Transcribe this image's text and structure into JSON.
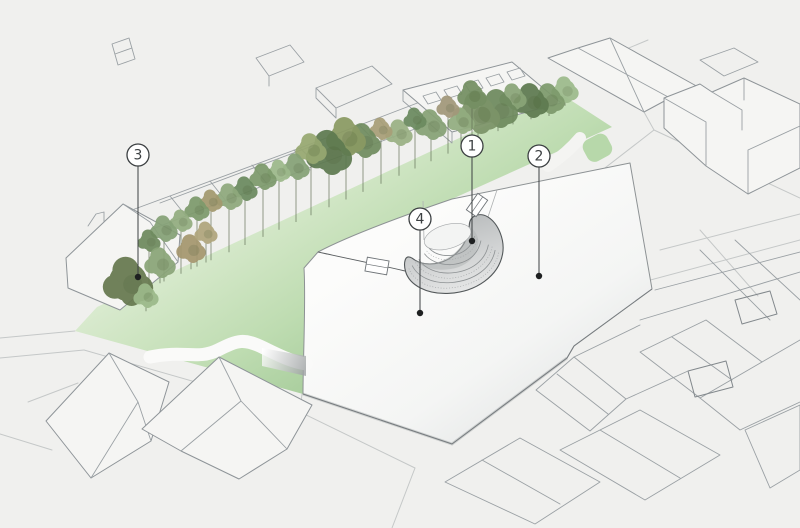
{
  "figure": {
    "callout_style": {
      "radius": 11,
      "ink": "#3c4042",
      "dot_color": "#1e2021",
      "fill": "#ffffff"
    },
    "callouts": [
      {
        "label": "1",
        "cx": 472,
        "cy": 146,
        "dot_y": 241
      },
      {
        "label": "2",
        "cx": 539,
        "cy": 156,
        "dot_y": 276
      },
      {
        "label": "3",
        "cx": 138,
        "cy": 155,
        "dot_y": 277
      },
      {
        "label": "4",
        "cx": 420,
        "cy": 219,
        "dot_y": 313
      }
    ],
    "palette": {
      "background": "#f0f0ee",
      "lawn_light": "#e6f1de",
      "lawn_mid": "#cfe5c3",
      "lawn_dark": "#abcf9f",
      "plaza_fill": "#fcfcfb",
      "plaza_shade": "#e2e4e4",
      "amphitheater_light": "#e6e7e7",
      "amphitheater_dark": "#b9bcbd",
      "outline_ink": "#53585a",
      "building_stroke": "#9aa0a4",
      "trunk": "#5d6b52"
    },
    "trees": [
      {
        "x": 565,
        "y": 90,
        "r": 13,
        "c": "#9dbb8c"
      },
      {
        "x": 549,
        "y": 99,
        "r": 15,
        "c": "#7d9a6c"
      },
      {
        "x": 531,
        "y": 101,
        "r": 17,
        "c": "#5e7a50"
      },
      {
        "x": 513,
        "y": 97,
        "r": 13,
        "c": "#8aa578"
      },
      {
        "x": 498,
        "y": 109,
        "r": 19,
        "c": "#6e8a5e"
      },
      {
        "x": 478,
        "y": 113,
        "r": 21,
        "c": "#7c9468"
      },
      {
        "x": 461,
        "y": 121,
        "r": 13,
        "c": "#93ad80"
      },
      {
        "x": 448,
        "y": 107,
        "r": 11,
        "c": "#a2987a"
      },
      {
        "x": 431,
        "y": 125,
        "r": 15,
        "c": "#87a276"
      },
      {
        "x": 415,
        "y": 119,
        "r": 11,
        "c": "#6b8a5f"
      },
      {
        "x": 399,
        "y": 133,
        "r": 13,
        "c": "#9ab184"
      },
      {
        "x": 381,
        "y": 129,
        "r": 11,
        "c": "#a89f78"
      },
      {
        "x": 363,
        "y": 141,
        "r": 17,
        "c": "#708c60"
      },
      {
        "x": 346,
        "y": 137,
        "r": 19,
        "c": "#8a9a63"
      },
      {
        "x": 329,
        "y": 153,
        "r": 22,
        "c": "#5e7a50"
      },
      {
        "x": 311,
        "y": 149,
        "r": 15,
        "c": "#97a871"
      },
      {
        "x": 296,
        "y": 167,
        "r": 13,
        "c": "#86a277"
      },
      {
        "x": 279,
        "y": 171,
        "r": 11,
        "c": "#9db98b"
      },
      {
        "x": 263,
        "y": 177,
        "r": 13,
        "c": "#7d9a6c"
      },
      {
        "x": 245,
        "y": 189,
        "r": 12,
        "c": "#6b8a5f"
      },
      {
        "x": 229,
        "y": 197,
        "r": 13,
        "c": "#8fa97d"
      },
      {
        "x": 211,
        "y": 201,
        "r": 11,
        "c": "#a3996f"
      },
      {
        "x": 197,
        "y": 209,
        "r": 12,
        "c": "#7d9a6c"
      },
      {
        "x": 181,
        "y": 221,
        "r": 11,
        "c": "#93ad80"
      },
      {
        "x": 164,
        "y": 229,
        "r": 13,
        "c": "#86a277"
      },
      {
        "x": 149,
        "y": 241,
        "r": 11,
        "c": "#6e8a5e"
      },
      {
        "x": 128,
        "y": 282,
        "r": 24,
        "c": "#66794f"
      },
      {
        "x": 160,
        "y": 263,
        "r": 15,
        "c": "#8aa578"
      },
      {
        "x": 146,
        "y": 296,
        "r": 12,
        "c": "#9cb98a"
      },
      {
        "x": 191,
        "y": 249,
        "r": 14,
        "c": "#a5976f"
      },
      {
        "x": 206,
        "y": 233,
        "r": 11,
        "c": "#b0a57c"
      },
      {
        "x": 472,
        "y": 95,
        "r": 14,
        "c": "#748f62"
      }
    ]
  }
}
